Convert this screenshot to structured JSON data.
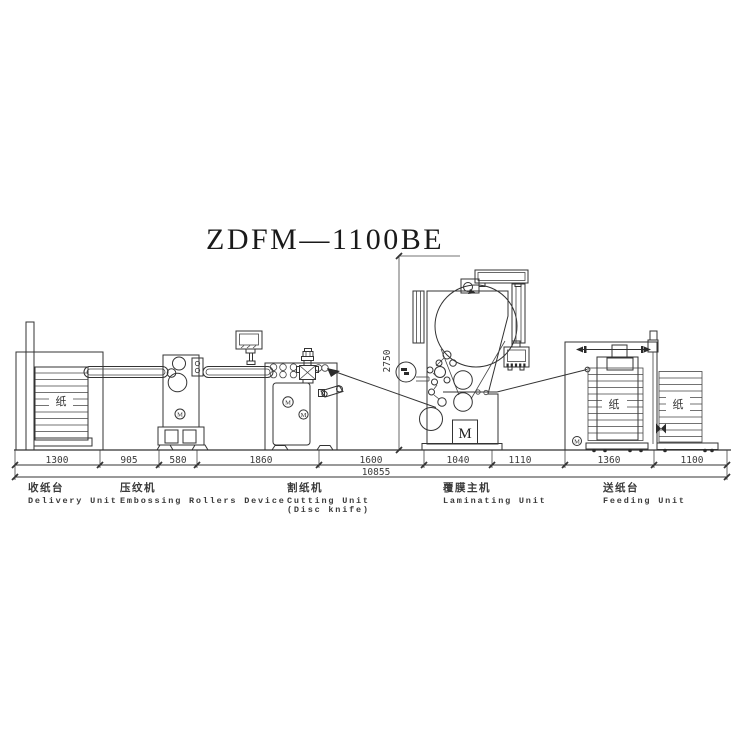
{
  "title": "ZDFM—1100BE",
  "dimensions": {
    "segments": [
      "1300",
      "905",
      "580",
      "1860",
      "1600",
      "1040",
      "1110",
      "1360",
      "1100"
    ],
    "total": "10855",
    "height": "2750"
  },
  "units": {
    "delivery": {
      "zh": "收纸台",
      "en": "Delivery Unit"
    },
    "embossing": {
      "zh": "压纹机",
      "en": "Embossing Rollers Device"
    },
    "cutting": {
      "zh": "割纸机",
      "en": "Cutting Unit",
      "en2": "(Disc knife)"
    },
    "laminating": {
      "zh": "覆膜主机",
      "en": "Laminating Unit"
    },
    "feeding": {
      "zh": "送纸台",
      "en": "Feeding Unit"
    }
  },
  "markers": {
    "paper": "纸",
    "motor": "M"
  },
  "colors": {
    "line": "#333333",
    "text": "#3a3a3a",
    "title": "#1a1a1a",
    "background": "#ffffff"
  }
}
